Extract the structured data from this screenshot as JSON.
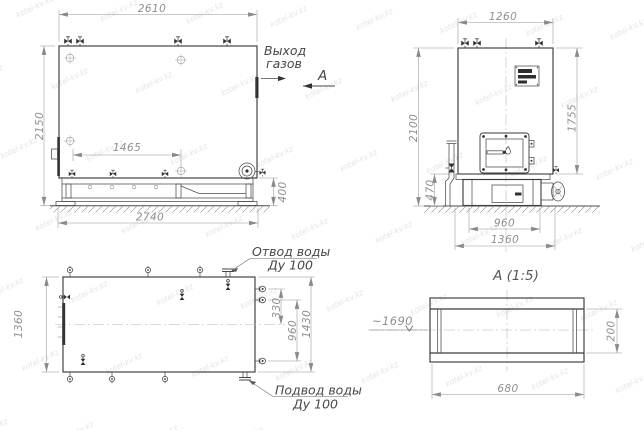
{
  "watermark": {
    "text": "kotel-kv.kz"
  },
  "side_view": {
    "dim_overall_width": "2610",
    "dim_overall_height": "2150",
    "dim_base_inner": "1465",
    "dim_base_height": "400",
    "dim_overall_length": "2740",
    "gas_outlet_line1": "Выход",
    "gas_outlet_line2": "газов",
    "section_label": "А"
  },
  "front_view": {
    "dim_width": "1260",
    "dim_height": "2100",
    "dim_body_height": "1755",
    "dim_base_height": "470",
    "dim_base_width": "960",
    "dim_base_outer_width": "1360"
  },
  "plan_view": {
    "dim_width": "1360",
    "dim_nozzle_offset": "330",
    "dim_nozzle_span": "960",
    "dim_overall": "1430",
    "water_outlet_line1": "Отвод воды",
    "water_outlet_line2": "Ду 100",
    "water_inlet_line1": "Подвод воды",
    "water_inlet_line2": "Ду 100"
  },
  "section_view": {
    "title": "А  (1:5)",
    "elevation": "~1690",
    "dim_height": "200",
    "dim_width": "680"
  }
}
